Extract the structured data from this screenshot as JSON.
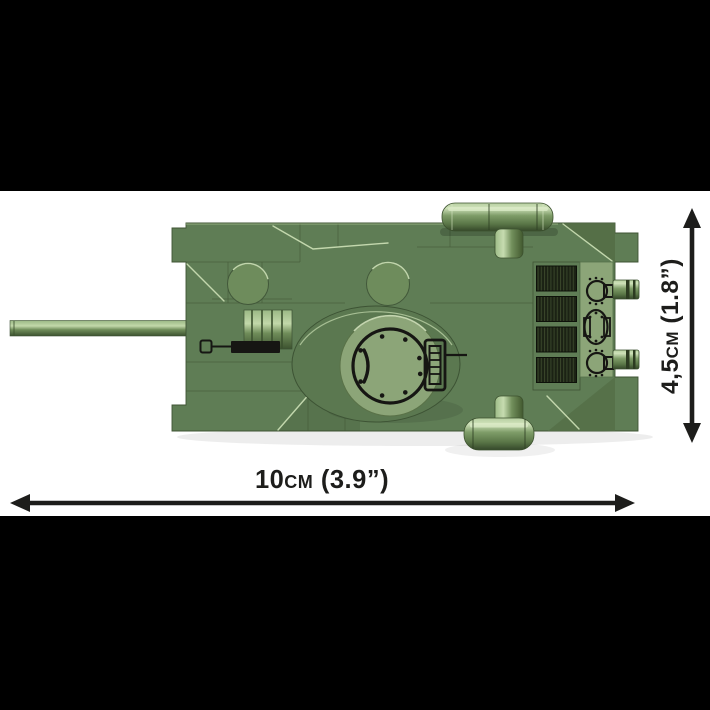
{
  "image": {
    "type": "product-dimension-photo",
    "subject": "brick-built tank model, top view",
    "orientation": "gun barrel pointing left"
  },
  "dimension_labels": {
    "width": "10cm (3.9”)",
    "height": "4,5cm (1.8”)"
  },
  "colors": {
    "background": "#ffffff",
    "letterbox": "#000000",
    "tank_green": "#5f7d55",
    "tank_green_dark": "#3f5434",
    "tank_green_light": "#8ca578",
    "highlight": "#c8dcb2",
    "print_black": "#161613",
    "grille_dark": "#1b2214",
    "arrow_color": "#1d1d1b"
  }
}
